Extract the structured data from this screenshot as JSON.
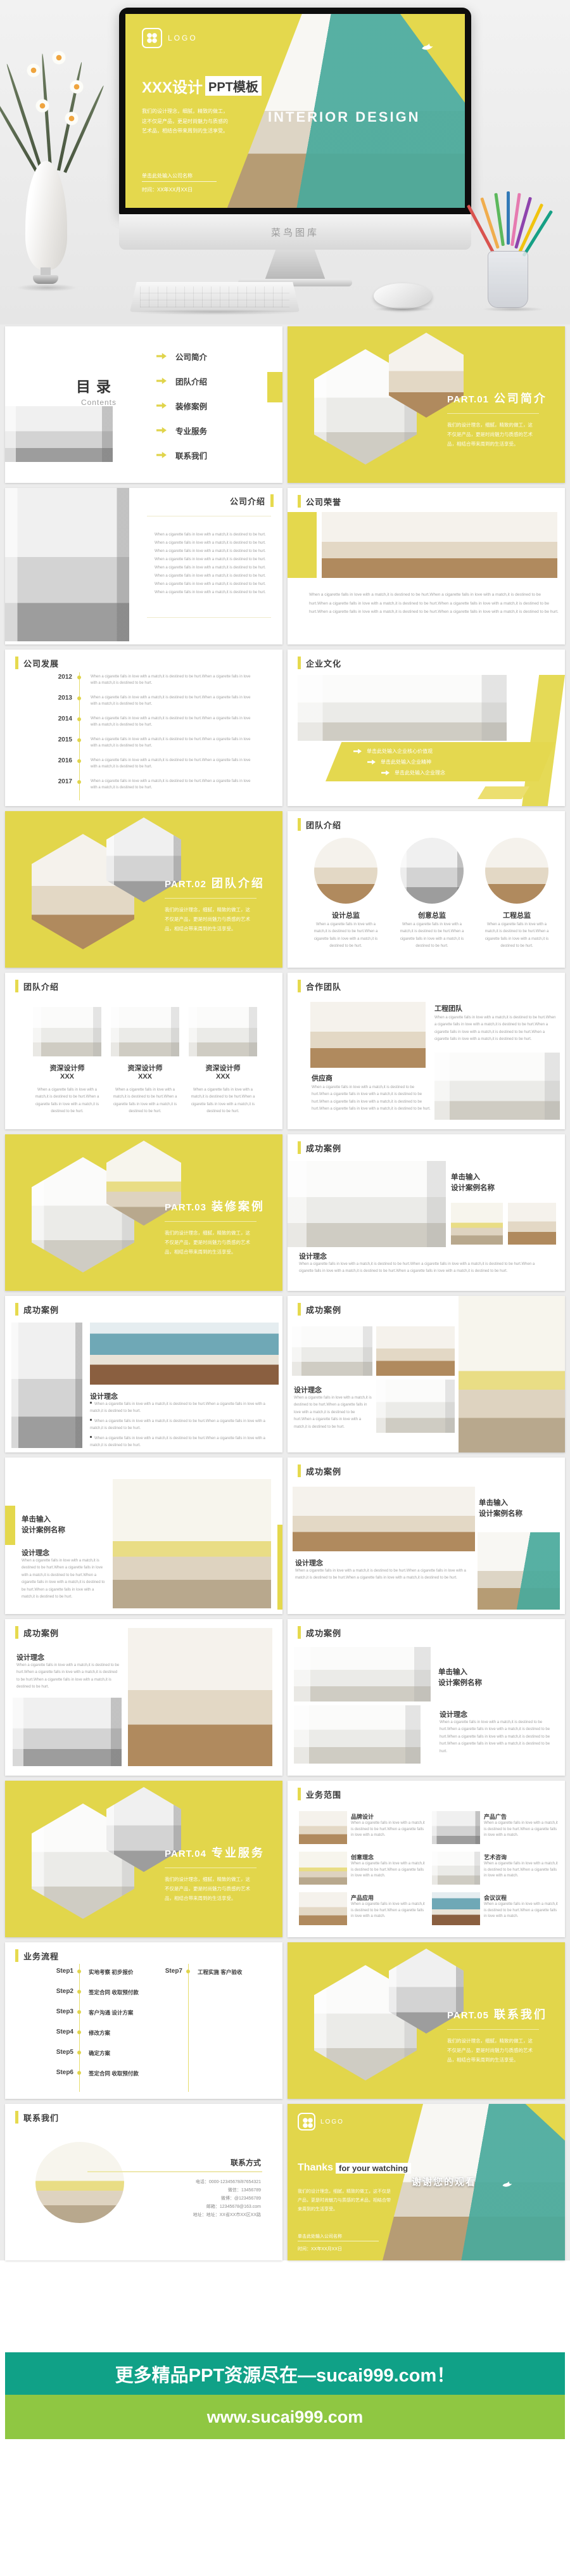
{
  "colors": {
    "yellow": "#e2d64b",
    "banner_teal": "#10a187",
    "banner_green": "#8fc742"
  },
  "hero": {
    "logo": "LOGO",
    "title_main": "XXX设计",
    "title_highlight": "PPT模板",
    "screen_caption": "INTERIOR DESIGN",
    "company_line": "单击此处输入公司名称",
    "date_line": "时间：XX年XX月XX日",
    "monitor_brand": "菜鸟图库"
  },
  "shared": {
    "lorem": "When a cigarette falls in love with a match,it is destined to be hurt.",
    "lorem_s": "When a cigarette falls in love with a match,it is destined to be hurt.When a cigarette falls in love with a match.",
    "lorem2": "When a cigarette falls in love with a match,it is destined to be hurt.When a cigarette falls in love with a match,it is destined to be hurt.",
    "lorem3": "When a cigarette falls in love with a match,it is destined to be hurt.When a cigarette falls in love with a match,it is destined to be hurt.When a cigarette falls in love with a match,it is destined to be hurt.",
    "lorem4": "When a cigarette falls in love with a match,it is destined to be hurt.When a cigarette falls in love with a match,it is destined to be hurt.When a cigarette falls in love with a match,it is destined to be hurt.When a cigarette falls in love with a match,it is destined to be hurt.",
    "lorem6": "When a cigarette falls in love with a match,it is destined to be hurt.When a cigarette falls in love with a match,it is destined to be hurt.When a cigarette falls in love with a match,it is destined to be hurt.When a cigarette falls in love with a match,it is destined to be hurt.When a cigarette falls in love with a match,it is destined to be hurt.When a cigarette falls in love with a match,it is destined to be hurt.",
    "section_body": "我们的设计理念，细腻，精致的做工，这不仅是产品，更是时尚魅力与质感的艺术品，相结合带来周到的生活享受。",
    "case_l1": "单击输入",
    "case_l2": "设计案例名称",
    "concept": "设计理念"
  },
  "slides": [
    {
      "name": "toc",
      "title": "目录",
      "subtitle": "Contents",
      "items": [
        "公司简介",
        "团队介绍",
        "装修案例",
        "专业服务",
        "联系我们"
      ]
    },
    {
      "name": "part-1",
      "part": "PART.01",
      "title": "公司简介"
    },
    {
      "name": "company-intro",
      "title": "公司介绍"
    },
    {
      "name": "company-honor",
      "title": "公司荣誉"
    },
    {
      "name": "company-dev",
      "title": "公司发展",
      "years": [
        "2012",
        "2013",
        "2014",
        "2015",
        "2016",
        "2017"
      ]
    },
    {
      "name": "culture",
      "title": "企业文化",
      "bullets": [
        "单击此处输入企业核心价值观",
        "单击此处输入企业精神",
        "单击此处输入企业理念"
      ]
    },
    {
      "name": "part-2",
      "part": "PART.02",
      "title": "团队介绍"
    },
    {
      "name": "team-directors",
      "title": "团队介绍",
      "roles": [
        "设计总监",
        "创意总监",
        "工程总监"
      ]
    },
    {
      "name": "team-designers",
      "title": "团队介绍",
      "role": "资深设计师",
      "role_name": "XXX"
    },
    {
      "name": "coop",
      "title": "合作团队",
      "block1": "工程团队",
      "block2": "供应商"
    },
    {
      "name": "part-3",
      "part": "PART.03",
      "title": "装修案例"
    },
    {
      "name": "case-1",
      "title": "成功案例"
    },
    {
      "name": "case-2",
      "title": "成功案例"
    },
    {
      "name": "case-3",
      "title": "成功案例"
    },
    {
      "name": "case-4",
      "title": "成功案例"
    },
    {
      "name": "case-5",
      "title": "成功案例"
    },
    {
      "name": "case-6",
      "title": "成功案例"
    },
    {
      "name": "case-7",
      "title": "成功案例"
    },
    {
      "name": "part-4",
      "part": "PART.04",
      "title": "专业服务"
    },
    {
      "name": "services",
      "title": "业务范围",
      "items": [
        "品牌设计",
        "产品广告",
        "创意理念",
        "艺术咨询",
        "产品应用",
        "会议议程"
      ]
    },
    {
      "name": "process",
      "title": "业务流程",
      "steps": [
        {
          "label": "Step1",
          "text": "实地考察 初步报价"
        },
        {
          "label": "Step2",
          "text": "签定合同 收取预付款"
        },
        {
          "label": "Step3",
          "text": "客户沟通 设计方案"
        },
        {
          "label": "Step4",
          "text": "修改方案"
        },
        {
          "label": "Step5",
          "text": "确定方案"
        },
        {
          "label": "Step6",
          "text": "签定合同 收取预付款"
        },
        {
          "label": "Step7",
          "text": "工程实施 客户验收"
        }
      ]
    },
    {
      "name": "part-5",
      "part": "PART.05",
      "title": "联系我们"
    },
    {
      "name": "contact",
      "title": "联系我们",
      "heading": "联系方式",
      "lines": [
        "电话：0000-12345678/87654321",
        "微信：13456789",
        "微博：@123456789",
        "邮箱：12345678@163.com",
        "地址：地址：XX省XX市XX区XX路"
      ]
    },
    {
      "name": "thanks",
      "logo": "LOGO",
      "title_main": "Thanks",
      "title_highlight": "for your watching",
      "overlay": "谢谢您的观看",
      "company_line": "单击此处输入公司名称",
      "date_line": "时间：XX年XX月XX日"
    }
  ],
  "footer": {
    "line1": "更多精品PPT资源尽在—sucai999.com！",
    "line2": "www.sucai999.com"
  }
}
